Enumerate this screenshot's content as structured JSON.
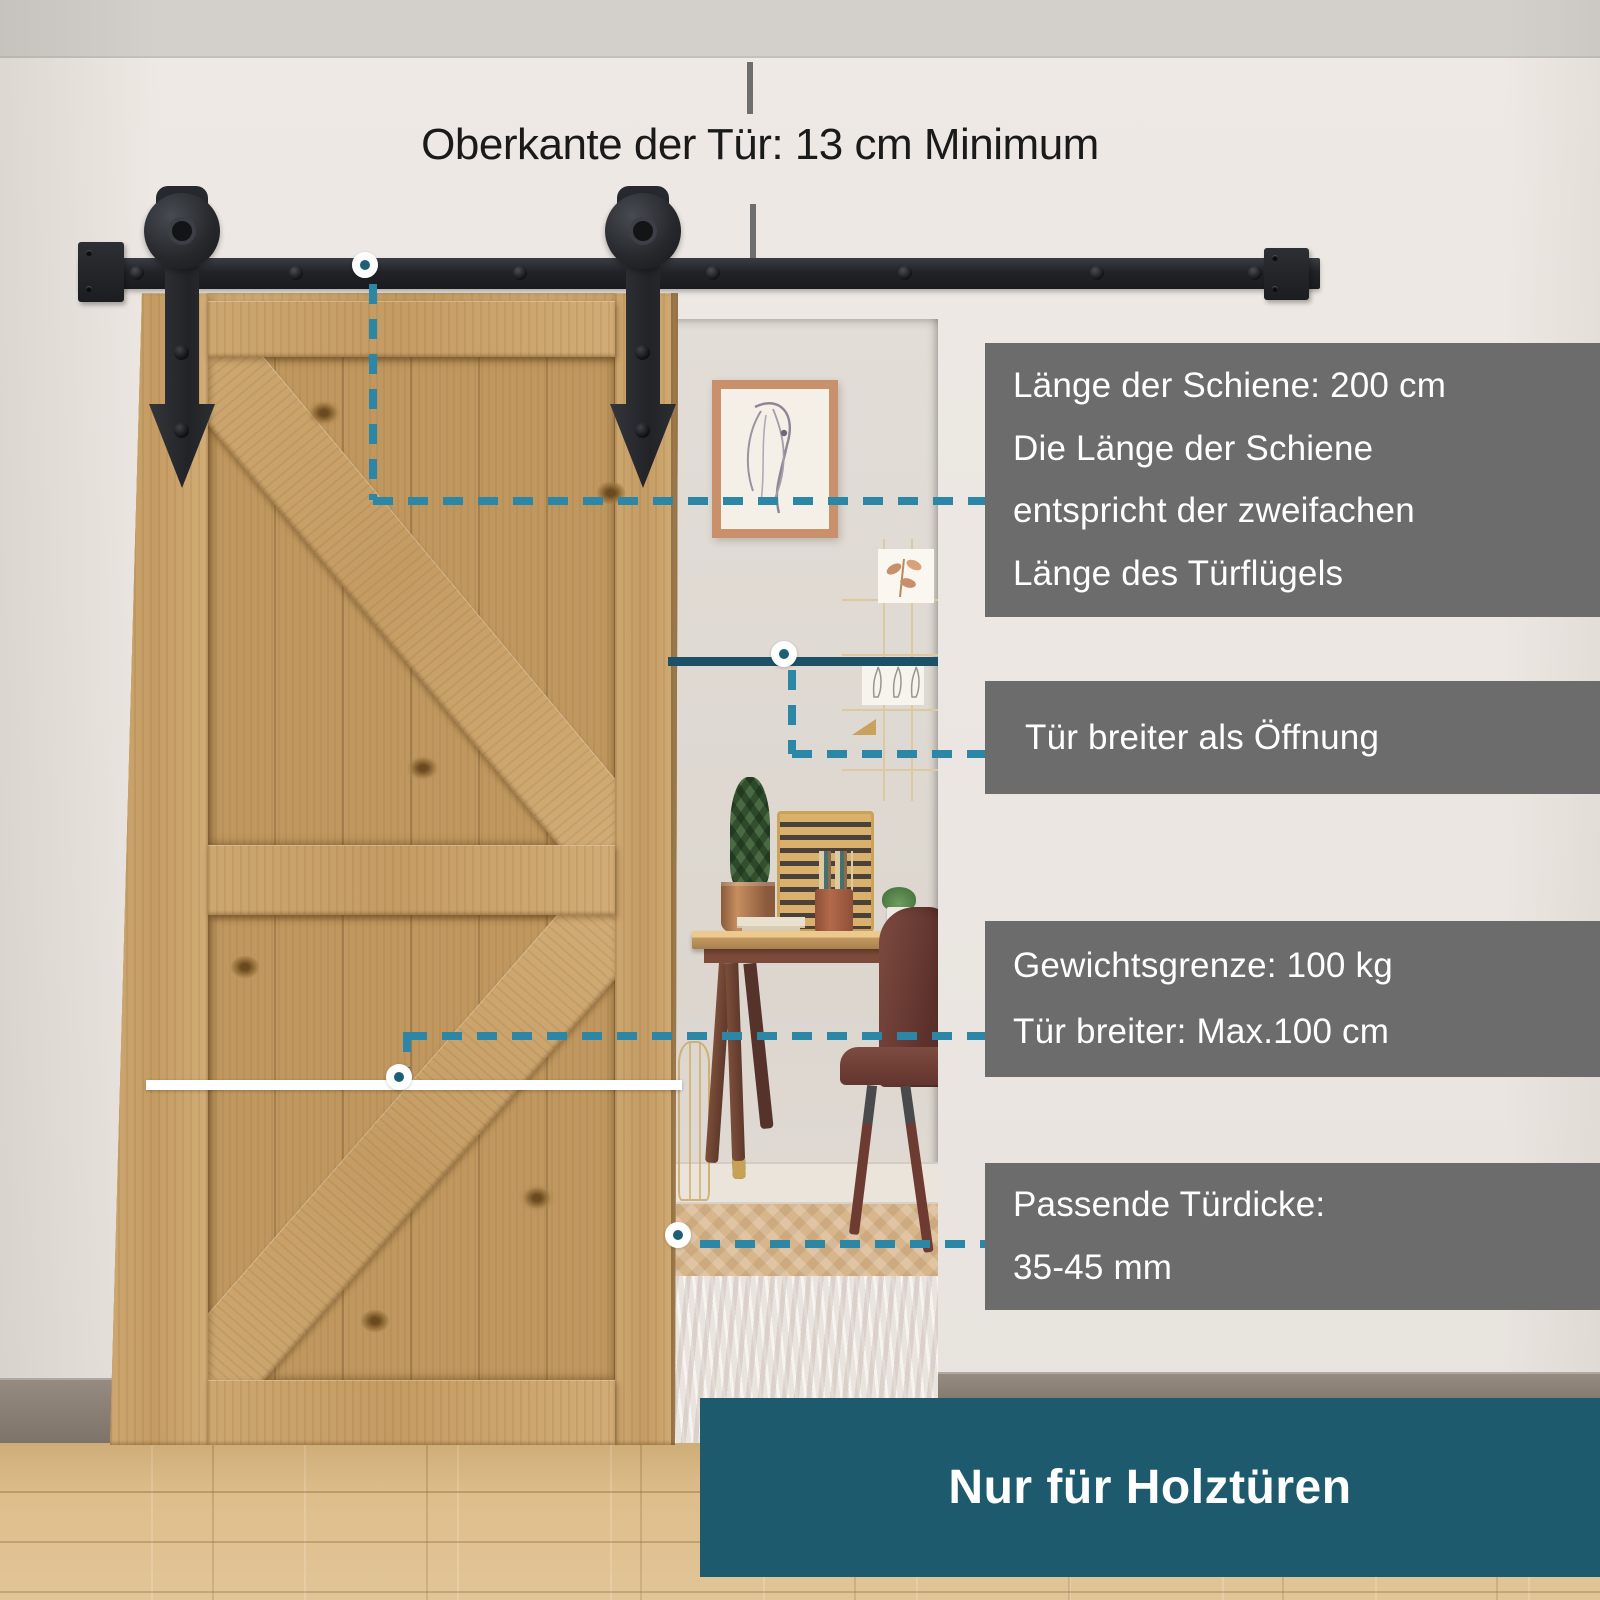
{
  "annotations": {
    "top_clearance": {
      "label": "Oberkante der Tür: 13 cm Minimum"
    },
    "rail_length": {
      "line1": "Länge der Schiene: 200 cm",
      "line2": "Die Länge der Schiene",
      "line3": "entspricht der zweifachen",
      "line4": "Länge des Türflügels"
    },
    "door_wider": {
      "line1": "Tür breiter als Öffnung"
    },
    "weight_limit": {
      "line1": "Gewichtsgrenze: 100 kg",
      "line2": "Tür breiter: Max.100 cm"
    },
    "door_thickness": {
      "line1": "Passende Türdicke:",
      "line2": "35-45 mm"
    },
    "banner": {
      "label": "Nur für Holztüren"
    }
  },
  "colors": {
    "teal_banner": "#1d5a6e",
    "teal_dash": "#2c87a6",
    "teal_dot": "#1d6075",
    "teal_solid": "#1d5168",
    "callout_bg": "#6c6c6c",
    "callout_text": "#ffffff",
    "label_text": "#1a1a1a",
    "white_line": "#ffffff",
    "ceiling": "#d3d0cc",
    "floor": "#dcba84",
    "door_wood": "#c59e66"
  }
}
